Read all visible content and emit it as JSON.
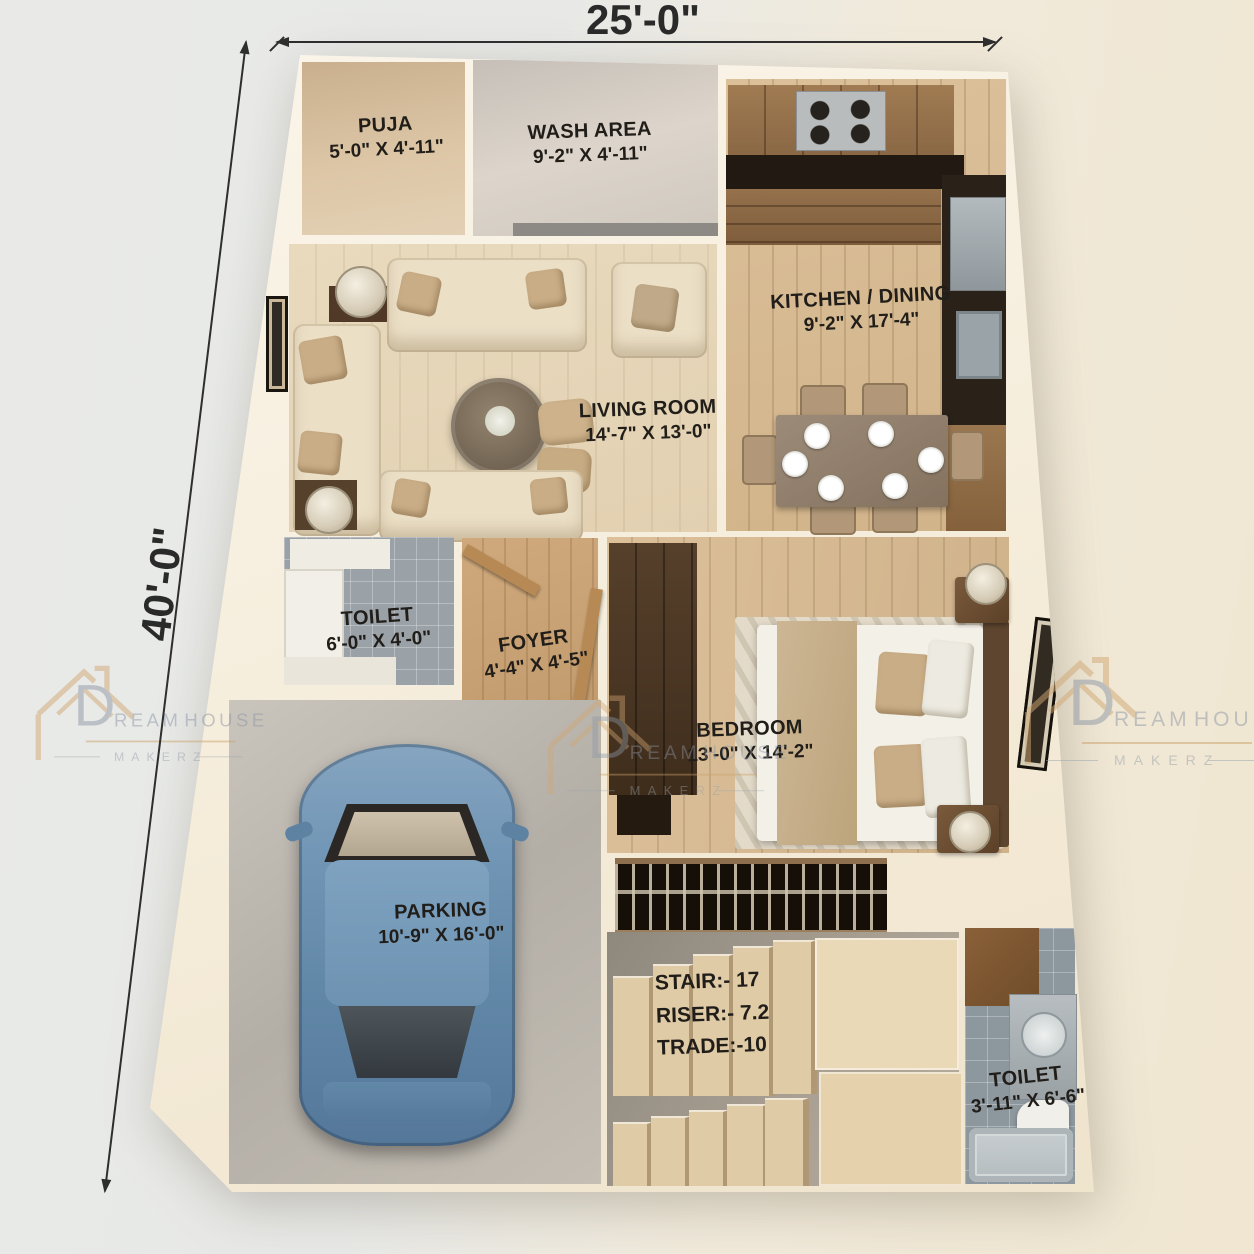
{
  "brand": {
    "name_initial": "D",
    "name_rest": "REAM",
    "name_word2": "HOUSE",
    "subtitle": "MAKERZ"
  },
  "dimensions": {
    "width_label": "25'-0\"",
    "height_label": "40'-0\""
  },
  "rooms": {
    "puja": {
      "name": "PUJA",
      "size": "5'-0\" X 4'-11\""
    },
    "wash": {
      "name": "WASH AREA",
      "size": "9'-2\" X 4'-11\""
    },
    "kitchen": {
      "name": "KITCHEN / DINING",
      "size": "9'-2\" X 17'-4\""
    },
    "living": {
      "name": "LIVING ROOM",
      "size": "14'-7\" X 13'-0\""
    },
    "toilet1": {
      "name": "TOILET",
      "size": "6'-0\" X 4'-0\""
    },
    "foyer": {
      "name": "FOYER",
      "size": "4'-4\" X 4'-5\""
    },
    "bedroom": {
      "name": "BEDROOM",
      "size": "13'-0\" X 14'-2\""
    },
    "parking": {
      "name": "PARKING",
      "size": "10'-9\" X 16'-0\""
    },
    "stair": {
      "line1": "STAIR:- 17",
      "line2": "RISER:- 7.2",
      "line3": "TRADE:-10"
    },
    "toilet2": {
      "name": "TOILET",
      "size": "3'-11\" X 6'-6\""
    }
  }
}
